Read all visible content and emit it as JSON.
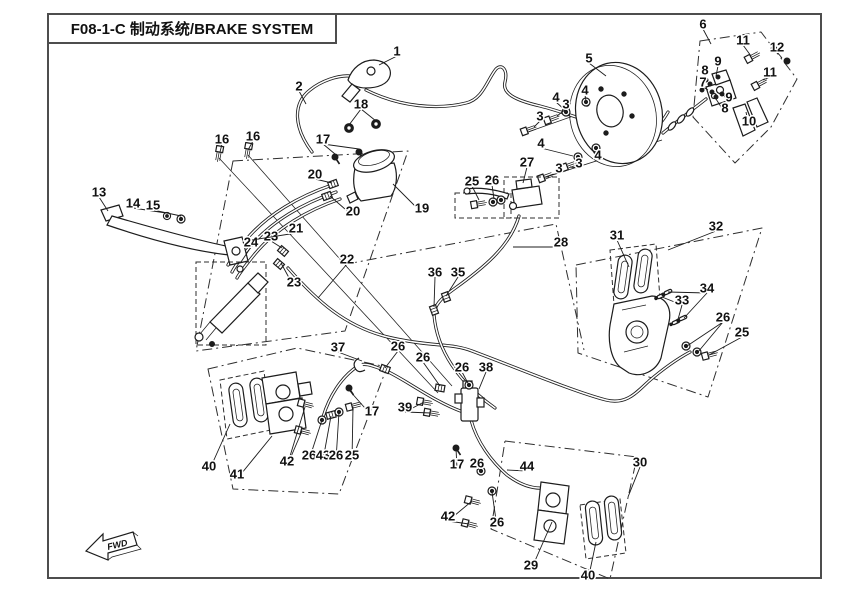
{
  "header": {
    "title": "F08-1-C 制动系统/BRAKE SYSTEM"
  },
  "fwd": {
    "label": "FWD"
  },
  "colors": {
    "line": "#1c1c1c",
    "border": "#4d4d4d",
    "background": "#ffffff"
  },
  "diagram": {
    "callouts": [
      {
        "n": "1",
        "x": 397,
        "y": 51,
        "leaders": [
          [
            379,
            65
          ]
        ]
      },
      {
        "n": "2",
        "x": 299,
        "y": 86,
        "leaders": [
          [
            306,
            104
          ]
        ]
      },
      {
        "n": "18",
        "x": 361,
        "y": 104,
        "leaders": [
          [
            349,
            125
          ],
          [
            376,
            121
          ]
        ]
      },
      {
        "n": "17",
        "x": 323,
        "y": 139,
        "leaders": [
          [
            335,
            154
          ],
          [
            359,
            149
          ]
        ]
      },
      {
        "n": "16",
        "x": 222,
        "y": 139,
        "leaders": [
          [
            220,
            152
          ]
        ]
      },
      {
        "n": "16",
        "x": 253,
        "y": 136,
        "leaders": [
          [
            248,
            150
          ]
        ]
      },
      {
        "n": "5",
        "x": 589,
        "y": 58,
        "leaders": [
          [
            606,
            76
          ]
        ]
      },
      {
        "n": "4",
        "x": 556,
        "y": 97,
        "leaders": [
          [
            566,
            111
          ]
        ]
      },
      {
        "n": "4",
        "x": 585,
        "y": 90,
        "leaders": [
          [
            586,
            101
          ]
        ]
      },
      {
        "n": "3",
        "x": 540,
        "y": 116,
        "leaders": [
          [
            534,
            127
          ]
        ]
      },
      {
        "n": "3",
        "x": 566,
        "y": 104,
        "leaders": [
          [
            557,
            116
          ]
        ]
      },
      {
        "n": "4",
        "x": 541,
        "y": 143,
        "leaders": [
          [
            573,
            156
          ]
        ]
      },
      {
        "n": "4",
        "x": 598,
        "y": 155,
        "leaders": [
          [
            592,
            149
          ]
        ]
      },
      {
        "n": "3",
        "x": 559,
        "y": 168,
        "leaders": [
          [
            551,
            175
          ]
        ]
      },
      {
        "n": "3",
        "x": 579,
        "y": 163,
        "leaders": [
          [
            570,
            167
          ]
        ]
      },
      {
        "n": "6",
        "x": 703,
        "y": 24,
        "leaders": [
          [
            711,
            44
          ]
        ]
      },
      {
        "n": "11",
        "x": 743,
        "y": 40,
        "leaders": [
          [
            751,
            56
          ]
        ]
      },
      {
        "n": "12",
        "x": 777,
        "y": 47,
        "leaders": [
          [
            782,
            58
          ]
        ]
      },
      {
        "n": "11",
        "x": 770,
        "y": 72,
        "leaders": [
          [
            763,
            80
          ]
        ]
      },
      {
        "n": "9",
        "x": 718,
        "y": 61,
        "leaders": [
          [
            716,
            76
          ]
        ]
      },
      {
        "n": "8",
        "x": 705,
        "y": 70,
        "leaders": [
          [
            707,
            81
          ]
        ]
      },
      {
        "n": "7",
        "x": 703,
        "y": 82,
        "leaders": [
          [
            708,
            90
          ]
        ]
      },
      {
        "n": "9",
        "x": 729,
        "y": 97,
        "leaders": [
          [
            721,
            92
          ]
        ]
      },
      {
        "n": "8",
        "x": 725,
        "y": 108,
        "leaders": [
          [
            716,
            99
          ]
        ]
      },
      {
        "n": "10",
        "x": 749,
        "y": 121,
        "leaders": [
          [
            746,
            112
          ]
        ]
      },
      {
        "n": "13",
        "x": 99,
        "y": 192,
        "leaders": [
          [
            108,
            211
          ]
        ]
      },
      {
        "n": "14",
        "x": 133,
        "y": 203,
        "leaders": [
          [
            166,
            213
          ]
        ]
      },
      {
        "n": "15",
        "x": 153,
        "y": 205,
        "leaders": [
          [
            181,
            216
          ]
        ]
      },
      {
        "n": "20",
        "x": 315,
        "y": 174,
        "leaders": [
          [
            332,
            183
          ]
        ]
      },
      {
        "n": "20",
        "x": 353,
        "y": 211,
        "leaders": [
          [
            330,
            196
          ]
        ]
      },
      {
        "n": "19",
        "x": 422,
        "y": 208,
        "leaders": [
          [
            393,
            184
          ]
        ]
      },
      {
        "n": "24",
        "x": 251,
        "y": 242,
        "leaders": [
          [
            241,
            262
          ]
        ]
      },
      {
        "n": "23",
        "x": 271,
        "y": 236,
        "leaders": [
          [
            282,
            248
          ]
        ]
      },
      {
        "n": "21",
        "x": 296,
        "y": 228,
        "leaders": [
          [
            252,
            240
          ]
        ]
      },
      {
        "n": "23",
        "x": 294,
        "y": 282,
        "leaders": [
          [
            281,
            263
          ]
        ]
      },
      {
        "n": "22",
        "x": 347,
        "y": 259,
        "leaders": [
          [
            318,
            298
          ]
        ]
      },
      {
        "n": "25",
        "x": 472,
        "y": 181,
        "leaders": [
          [
            479,
            200
          ]
        ]
      },
      {
        "n": "26",
        "x": 492,
        "y": 180,
        "leaders": [
          [
            494,
            199
          ]
        ]
      },
      {
        "n": "27",
        "x": 527,
        "y": 162,
        "leaders": [
          [
            523,
            183
          ]
        ]
      },
      {
        "n": "28",
        "x": 561,
        "y": 242,
        "leaders": [
          [
            513,
            247
          ]
        ]
      },
      {
        "n": "36",
        "x": 435,
        "y": 272,
        "leaders": [
          [
            434,
            307
          ]
        ]
      },
      {
        "n": "35",
        "x": 458,
        "y": 272,
        "leaders": [
          [
            446,
            296
          ]
        ]
      },
      {
        "n": "31",
        "x": 617,
        "y": 235,
        "leaders": [
          [
            629,
            267
          ]
        ]
      },
      {
        "n": "32",
        "x": 716,
        "y": 226,
        "leaders": [
          [
            668,
            250
          ]
        ]
      },
      {
        "n": "33",
        "x": 682,
        "y": 300,
        "leaders": [
          [
            662,
            297
          ],
          [
            677,
            323
          ]
        ]
      },
      {
        "n": "34",
        "x": 707,
        "y": 288,
        "leaders": [
          [
            668,
            292
          ],
          [
            684,
            318
          ]
        ]
      },
      {
        "n": "26",
        "x": 723,
        "y": 317,
        "leaders": [
          [
            687,
            346
          ],
          [
            698,
            352
          ]
        ]
      },
      {
        "n": "25",
        "x": 742,
        "y": 332,
        "leaders": [
          [
            709,
            355
          ]
        ]
      },
      {
        "n": "37",
        "x": 338,
        "y": 347,
        "leaders": [
          [
            362,
            361
          ]
        ]
      },
      {
        "n": "26",
        "x": 398,
        "y": 346,
        "leaders": [
          [
            385,
            368
          ]
        ]
      },
      {
        "n": "26",
        "x": 423,
        "y": 357,
        "leaders": [
          [
            440,
            386
          ]
        ]
      },
      {
        "n": "26",
        "x": 462,
        "y": 367,
        "leaders": [
          [
            469,
            385
          ]
        ]
      },
      {
        "n": "38",
        "x": 486,
        "y": 367,
        "leaders": [
          [
            479,
            389
          ]
        ]
      },
      {
        "n": "39",
        "x": 405,
        "y": 407,
        "leaders": [
          [
            424,
            402
          ],
          [
            431,
            413
          ]
        ]
      },
      {
        "n": "17",
        "x": 372,
        "y": 411,
        "leaders": [
          [
            349,
            390
          ]
        ]
      },
      {
        "n": "40",
        "x": 209,
        "y": 466,
        "leaders": [
          [
            230,
            424
          ]
        ]
      },
      {
        "n": "41",
        "x": 237,
        "y": 474,
        "leaders": [
          [
            272,
            436
          ]
        ]
      },
      {
        "n": "42",
        "x": 287,
        "y": 461,
        "leaders": [
          [
            305,
            407
          ],
          [
            302,
            431
          ]
        ]
      },
      {
        "n": "26",
        "x": 309,
        "y": 455,
        "leaders": [
          [
            322,
            420
          ]
        ]
      },
      {
        "n": "43",
        "x": 323,
        "y": 455,
        "leaders": [
          [
            331,
            416
          ]
        ]
      },
      {
        "n": "26",
        "x": 336,
        "y": 455,
        "leaders": [
          [
            339,
            412
          ]
        ]
      },
      {
        "n": "25",
        "x": 352,
        "y": 455,
        "leaders": [
          [
            353,
            407
          ]
        ]
      },
      {
        "n": "17",
        "x": 457,
        "y": 464,
        "leaders": [
          [
            456,
            448
          ]
        ]
      },
      {
        "n": "26",
        "x": 477,
        "y": 463,
        "leaders": [
          [
            481,
            471
          ]
        ]
      },
      {
        "n": "44",
        "x": 527,
        "y": 466,
        "leaders": [
          [
            507,
            470
          ]
        ]
      },
      {
        "n": "30",
        "x": 640,
        "y": 462,
        "leaders": [
          [
            628,
            497
          ]
        ]
      },
      {
        "n": "42",
        "x": 448,
        "y": 516,
        "leaders": [
          [
            472,
            501
          ],
          [
            469,
            524
          ]
        ]
      },
      {
        "n": "26",
        "x": 497,
        "y": 522,
        "leaders": [
          [
            492,
            492
          ]
        ]
      },
      {
        "n": "29",
        "x": 531,
        "y": 565,
        "leaders": [
          [
            552,
            522
          ]
        ]
      },
      {
        "n": "40",
        "x": 588,
        "y": 575,
        "leaders": [
          [
            596,
            542
          ]
        ]
      }
    ]
  }
}
